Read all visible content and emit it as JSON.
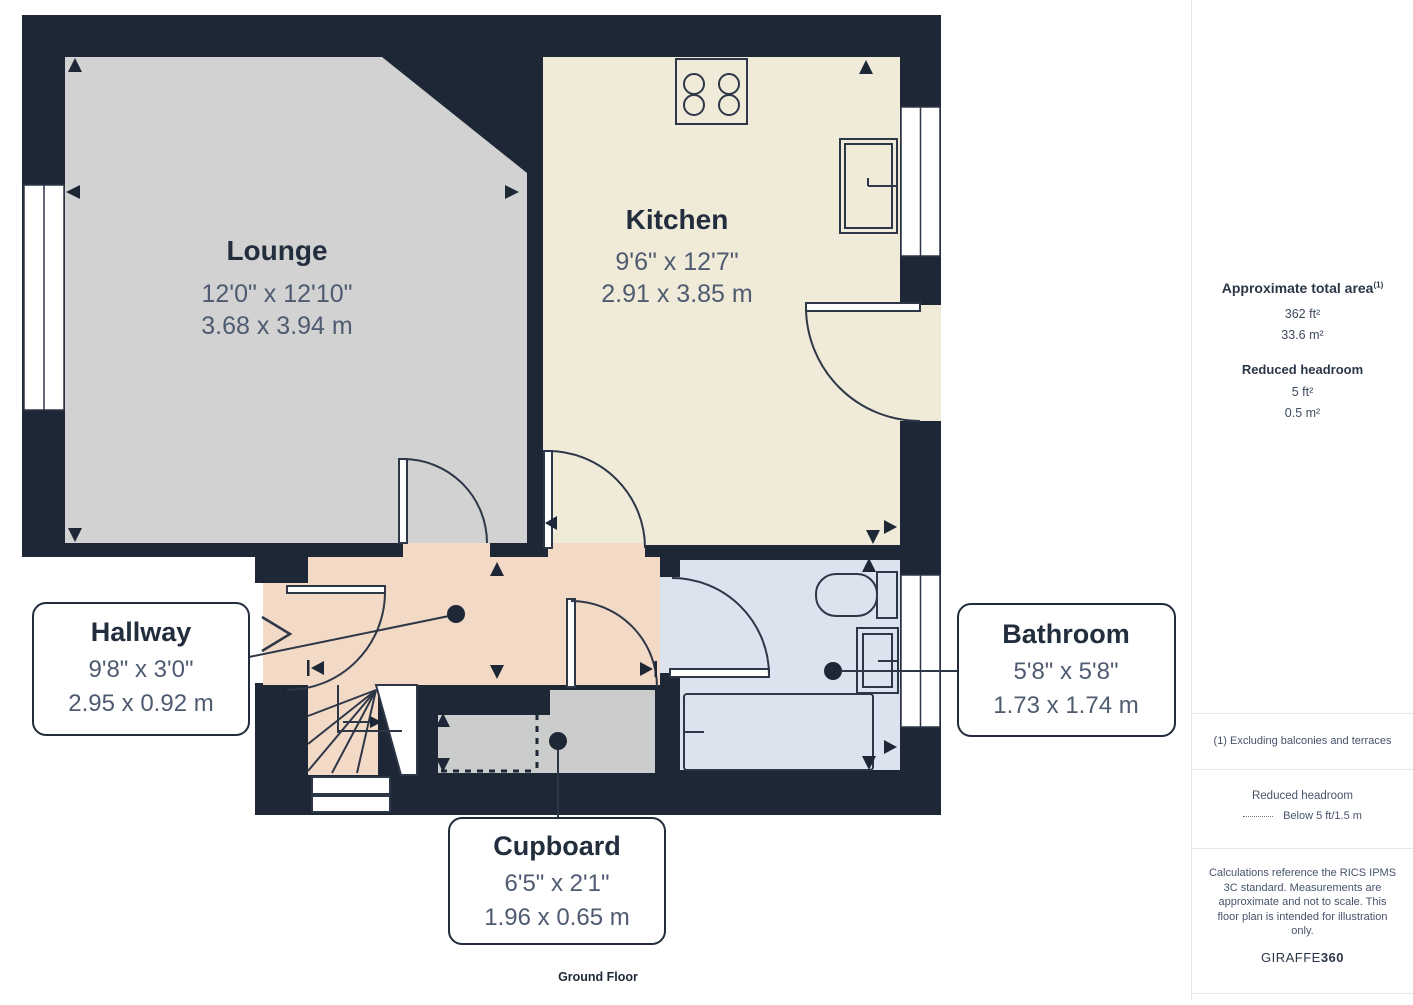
{
  "plan": {
    "floor_label": "Ground Floor",
    "rooms": {
      "lounge": {
        "name": "Lounge",
        "imperial": "12'0\" x 12'10\"",
        "metric": "3.68 x 3.94 m"
      },
      "kitchen": {
        "name": "Kitchen",
        "imperial": "9'6\" x 12'7\"",
        "metric": "2.91 x 3.85 m"
      },
      "hallway": {
        "name": "Hallway",
        "imperial": "9'8\" x 3'0\"",
        "metric": "2.95 x 0.92 m"
      },
      "bathroom": {
        "name": "Bathroom",
        "imperial": "5'8\" x 5'8\"",
        "metric": "1.73 x 1.74 m"
      },
      "cupboard": {
        "name": "Cupboard",
        "imperial": "6'5\" x 2'1\"",
        "metric": "1.96 x 0.65 m"
      }
    }
  },
  "sidebar": {
    "total_area": {
      "title": "Approximate total area",
      "superscript": "(1)",
      "imperial": "362 ft²",
      "metric": "33.6 m²"
    },
    "reduced_headroom": {
      "title": "Reduced headroom",
      "imperial": "5 ft²",
      "metric": "0.5 m²"
    },
    "footnote": "(1) Excluding balconies and terraces",
    "legend": {
      "title": "Reduced headroom",
      "entry": "Below 5 ft/1.5 m"
    },
    "disclaimer": "Calculations reference the RICS IPMS 3C standard. Measurements are approximate and not to scale. This floor plan is intended for illustration only.",
    "brand": {
      "name": "GIRAFFE",
      "suffix": "360"
    }
  },
  "colors": {
    "wall": "#1d2735",
    "lounge_fill": "#d2d2d3",
    "kitchen_fill": "#f0ebd9",
    "hallway_fill": "#f3dac7",
    "bathroom_fill": "#dce2ee",
    "cupboard_fill": "#cbcccc",
    "line": "#2e3747",
    "dim_text": "#4e5b70",
    "name_text": "#222d3d"
  }
}
